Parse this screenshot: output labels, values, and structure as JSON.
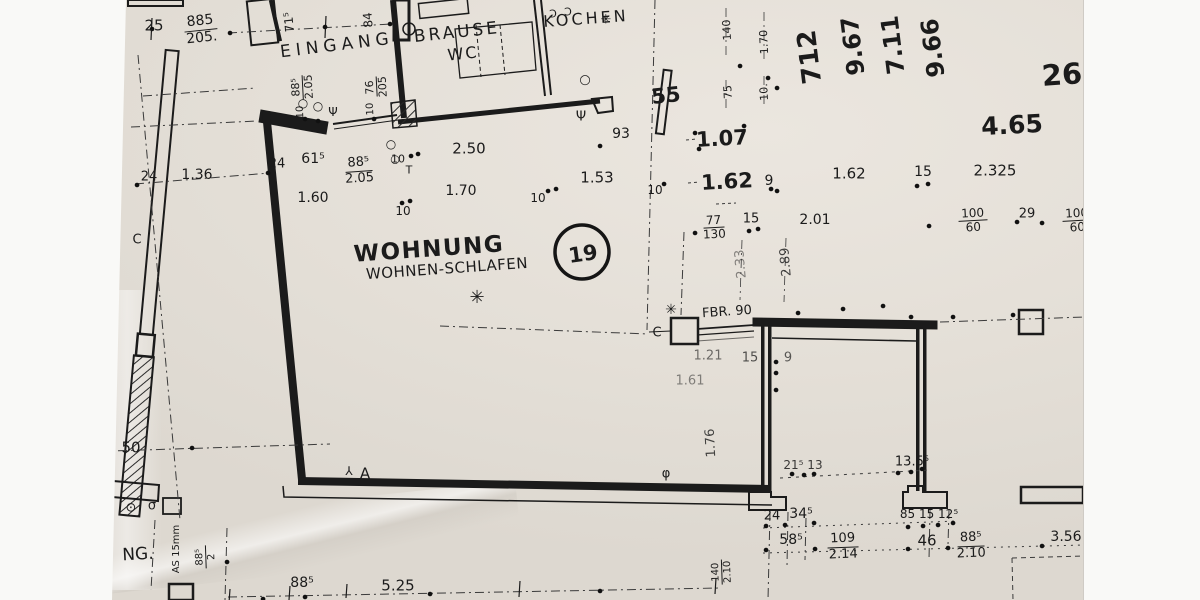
{
  "meta": {
    "title": "Scanned floor plan – apartment 19"
  },
  "palette": {
    "paper": "#e4dfd7",
    "ink": "#1b1b1b",
    "faint": "#3a3a3a",
    "margin": "#f9f9f7"
  },
  "unit_circle": {
    "number": "19"
  },
  "room": {
    "name": "WOHNUNG",
    "subtitle": "WOHNEN-SCHLAFEN"
  },
  "texts": [
    {
      "t": "EINGANG",
      "x": 337,
      "y": 46,
      "s": 17,
      "r": -7,
      "ls": 5,
      "n": "room-label-eingang"
    },
    {
      "t": "BRAUSE",
      "x": 457,
      "y": 33,
      "s": 17,
      "r": -6,
      "ls": 3,
      "n": "room-label-brause"
    },
    {
      "t": "WC",
      "x": 463,
      "y": 54,
      "s": 16,
      "r": -6,
      "ls": 2,
      "n": "room-label-wc"
    },
    {
      "t": "KOCHEN",
      "x": 586,
      "y": 19,
      "s": 16,
      "r": -4,
      "ls": 3,
      "n": "room-label-kochen"
    },
    {
      "t": "WOHNUNG",
      "x": 429,
      "y": 250,
      "s": 23,
      "r": -4,
      "b": 1,
      "ls": 1.5,
      "n": "room-label-wohnung"
    },
    {
      "t": "WOHNEN-SCHLAFEN",
      "x": 447,
      "y": 269,
      "s": 15,
      "r": -4,
      "ls": 0.5,
      "n": "room-label-wohnen-schlafen"
    },
    {
      "t": "FBR. 90",
      "x": 727,
      "y": 312,
      "s": 13,
      "r": -4,
      "n": "label-fbr-90"
    },
    {
      "t": "NG.",
      "x": 138,
      "y": 555,
      "s": 17,
      "r": -3,
      "n": "label-ng"
    },
    {
      "t": "AS 15mm",
      "x": 177,
      "y": 549,
      "s": 10,
      "r": -90,
      "n": "label-as-15mm"
    },
    {
      "t": "712",
      "x": 810,
      "y": 57,
      "s": 26,
      "r": -97,
      "b": 1
    },
    {
      "t": "9.67",
      "x": 853,
      "y": 46,
      "s": 24,
      "r": -97,
      "b": 1
    },
    {
      "t": "7.11",
      "x": 893,
      "y": 45,
      "s": 24,
      "r": -97,
      "b": 1
    },
    {
      "t": "9.66",
      "x": 933,
      "y": 48,
      "s": 24,
      "r": -97,
      "b": 1
    },
    {
      "t": "26",
      "x": 1062,
      "y": 75,
      "s": 29,
      "r": -4,
      "b": 1
    },
    {
      "t": "4.65",
      "x": 1012,
      "y": 125,
      "s": 25,
      "r": -3,
      "b": 1
    },
    {
      "t": "55",
      "x": 666,
      "y": 96,
      "s": 21,
      "r": -6,
      "b": 1
    },
    {
      "t": "1.07",
      "x": 722,
      "y": 139,
      "s": 21,
      "r": -3,
      "b": 1
    },
    {
      "t": "1.62",
      "x": 727,
      "y": 182,
      "s": 21,
      "r": -3,
      "b": 1
    },
    {
      "t": "25",
      "x": 154,
      "y": 26,
      "s": 15
    },
    {
      "t": "1.36",
      "x": 197,
      "y": 175,
      "s": 14
    },
    {
      "t": "24",
      "x": 149,
      "y": 177,
      "s": 13
    },
    {
      "t": "24",
      "x": 277,
      "y": 164,
      "s": 13
    },
    {
      "t": "61⁵",
      "x": 313,
      "y": 159,
      "s": 14
    },
    {
      "t": "1.60",
      "x": 313,
      "y": 198,
      "s": 14
    },
    {
      "t": "2.50",
      "x": 469,
      "y": 149,
      "s": 15
    },
    {
      "t": "1.70",
      "x": 461,
      "y": 191,
      "s": 14
    },
    {
      "t": "93",
      "x": 621,
      "y": 134,
      "s": 14
    },
    {
      "t": "1.53",
      "x": 597,
      "y": 178,
      "s": 15
    },
    {
      "t": "10",
      "x": 538,
      "y": 198,
      "s": 12
    },
    {
      "t": "10",
      "x": 655,
      "y": 190,
      "s": 12
    },
    {
      "t": "10",
      "x": 398,
      "y": 159,
      "s": 11
    },
    {
      "t": "10",
      "x": 403,
      "y": 211,
      "s": 12
    },
    {
      "t": "9",
      "x": 769,
      "y": 181,
      "s": 14
    },
    {
      "t": "1.62",
      "x": 849,
      "y": 174,
      "s": 15
    },
    {
      "t": "15",
      "x": 923,
      "y": 172,
      "s": 14
    },
    {
      "t": "2.325",
      "x": 995,
      "y": 171,
      "s": 15
    },
    {
      "t": "2.01",
      "x": 815,
      "y": 220,
      "s": 14
    },
    {
      "t": "15",
      "x": 751,
      "y": 219,
      "s": 13
    },
    {
      "t": "29",
      "x": 1027,
      "y": 214,
      "s": 13
    },
    {
      "t": "1.21",
      "x": 708,
      "y": 356,
      "s": 13,
      "o": 0.6
    },
    {
      "t": "15",
      "x": 750,
      "y": 358,
      "s": 13,
      "o": 0.75
    },
    {
      "t": "9",
      "x": 788,
      "y": 358,
      "s": 13,
      "o": 0.7
    },
    {
      "t": "1.61",
      "x": 690,
      "y": 381,
      "s": 13,
      "o": 0.5
    },
    {
      "t": "21⁵ 13",
      "x": 803,
      "y": 465,
      "s": 12,
      "o": 0.85
    },
    {
      "t": "13.5⁵",
      "x": 912,
      "y": 462,
      "s": 13
    },
    {
      "t": "24",
      "x": 772,
      "y": 516,
      "s": 13
    },
    {
      "t": "34⁵",
      "x": 801,
      "y": 514,
      "s": 14
    },
    {
      "t": "58⁵",
      "x": 791,
      "y": 540,
      "s": 14
    },
    {
      "t": "85 15 12⁵",
      "x": 929,
      "y": 514,
      "s": 12
    },
    {
      "t": "46",
      "x": 927,
      "y": 541,
      "s": 15
    },
    {
      "t": "3.56",
      "x": 1066,
      "y": 537,
      "s": 14
    },
    {
      "t": "50",
      "x": 131,
      "y": 448,
      "s": 15
    },
    {
      "t": "88⁵",
      "x": 302,
      "y": 583,
      "s": 14
    },
    {
      "t": "5.25",
      "x": 398,
      "y": 586,
      "s": 15
    },
    {
      "t": "71⁵",
      "x": 289,
      "y": 22,
      "s": 12,
      "r": -96
    },
    {
      "t": "84",
      "x": 368,
      "y": 20,
      "s": 12,
      "r": -95
    },
    {
      "t": "140",
      "x": 727,
      "y": 30,
      "s": 11,
      "r": -93
    },
    {
      "t": "1.70",
      "x": 764,
      "y": 42,
      "s": 11,
      "r": -93
    },
    {
      "t": "75",
      "x": 728,
      "y": 92,
      "s": 11,
      "r": -93
    },
    {
      "t": "10.",
      "x": 764,
      "y": 92,
      "s": 11,
      "r": -93
    },
    {
      "t": "2.33",
      "x": 741,
      "y": 264,
      "s": 13,
      "r": -95,
      "o": 0.5
    },
    {
      "t": "2.89",
      "x": 786,
      "y": 262,
      "s": 13,
      "r": -95,
      "o": 0.8
    },
    {
      "t": "1.76",
      "x": 711,
      "y": 443,
      "s": 13,
      "r": -93,
      "o": 0.8
    },
    {
      "t": "10",
      "x": 371,
      "y": 109,
      "s": 10,
      "r": -93
    },
    {
      "t": "10",
      "x": 301,
      "y": 112,
      "s": 10,
      "r": -93
    },
    {
      "t": "✳",
      "x": 477,
      "y": 298,
      "s": 18,
      "n": "star-symbol"
    },
    {
      "t": "✳",
      "x": 671,
      "y": 310,
      "s": 14,
      "n": "star-symbol"
    },
    {
      "t": "✳",
      "x": 606,
      "y": 20,
      "s": 13,
      "n": "star-symbol"
    },
    {
      "t": "C",
      "x": 137,
      "y": 240,
      "s": 13,
      "n": "section-mark-c"
    },
    {
      "t": "C",
      "x": 657,
      "y": 333,
      "s": 13,
      "n": "section-mark-c"
    },
    {
      "t": "A",
      "x": 365,
      "y": 474,
      "s": 15,
      "n": "label-a"
    },
    {
      "t": "⅄",
      "x": 349,
      "y": 471,
      "s": 12,
      "n": "switch-symbol"
    },
    {
      "t": "Ψ",
      "x": 581,
      "y": 117,
      "s": 13,
      "n": "fixture-symbol"
    },
    {
      "t": "Ψ",
      "x": 333,
      "y": 112,
      "s": 12,
      "n": "fixture-symbol"
    },
    {
      "t": "○",
      "x": 585,
      "y": 80,
      "s": 13,
      "n": "door-swing-symbol"
    },
    {
      "t": "○",
      "x": 303,
      "y": 103,
      "s": 12,
      "n": "door-swing-symbol"
    },
    {
      "t": "○",
      "x": 318,
      "y": 106,
      "s": 12,
      "n": "door-swing-symbol"
    },
    {
      "t": "○",
      "x": 391,
      "y": 144,
      "s": 12,
      "n": "door-swing-symbol"
    },
    {
      "t": "○",
      "x": 395,
      "y": 159,
      "s": 11,
      "n": "door-swing-symbol"
    },
    {
      "t": "⊙",
      "x": 131,
      "y": 508,
      "s": 13,
      "n": "outlet-symbol"
    },
    {
      "t": "σ",
      "x": 152,
      "y": 506,
      "s": 13,
      "n": "outlet-symbol"
    },
    {
      "t": "T",
      "x": 409,
      "y": 170,
      "s": 11,
      "n": "fixture-symbol"
    },
    {
      "t": "Ɔ",
      "x": 553,
      "y": 14,
      "s": 11,
      "n": "door-arc-symbol"
    },
    {
      "t": "Ɔ",
      "x": 568,
      "y": 12,
      "s": 11,
      "n": "door-arc-symbol"
    },
    {
      "t": "φ",
      "x": 666,
      "y": 474,
      "s": 13,
      "n": "door-swing-symbol"
    }
  ],
  "fractions": [
    {
      "top": "885",
      "bot": "205.",
      "x": 201,
      "y": 30,
      "s": 14,
      "r": -6
    },
    {
      "top": "88⁵",
      "bot": "2.05",
      "x": 303,
      "y": 87,
      "s": 11,
      "r": -93
    },
    {
      "top": "76",
      "bot": "205",
      "x": 377,
      "y": 87,
      "s": 11,
      "r": -93
    },
    {
      "top": "88⁵",
      "bot": "2.05",
      "x": 359,
      "y": 171,
      "s": 13,
      "r": -4
    },
    {
      "top": "77",
      "bot": "130",
      "x": 714,
      "y": 228,
      "s": 12,
      "r": -3
    },
    {
      "top": "100",
      "bot": "60",
      "x": 973,
      "y": 221,
      "s": 12,
      "r": -3
    },
    {
      "top": "100",
      "bot": "60",
      "x": 1077,
      "y": 221,
      "s": 12,
      "r": -3
    },
    {
      "top": "109",
      "bot": "2.14",
      "x": 843,
      "y": 547,
      "s": 13,
      "r": -2
    },
    {
      "top": "88⁵",
      "bot": "2.10",
      "x": 971,
      "y": 546,
      "s": 13,
      "r": -2
    },
    {
      "top": "140",
      "bot": "2.10",
      "x": 722,
      "y": 572,
      "s": 10,
      "r": -92
    },
    {
      "top": "88⁵",
      "bot": "2",
      "x": 206,
      "y": 557,
      "s": 10,
      "r": -92
    }
  ]
}
